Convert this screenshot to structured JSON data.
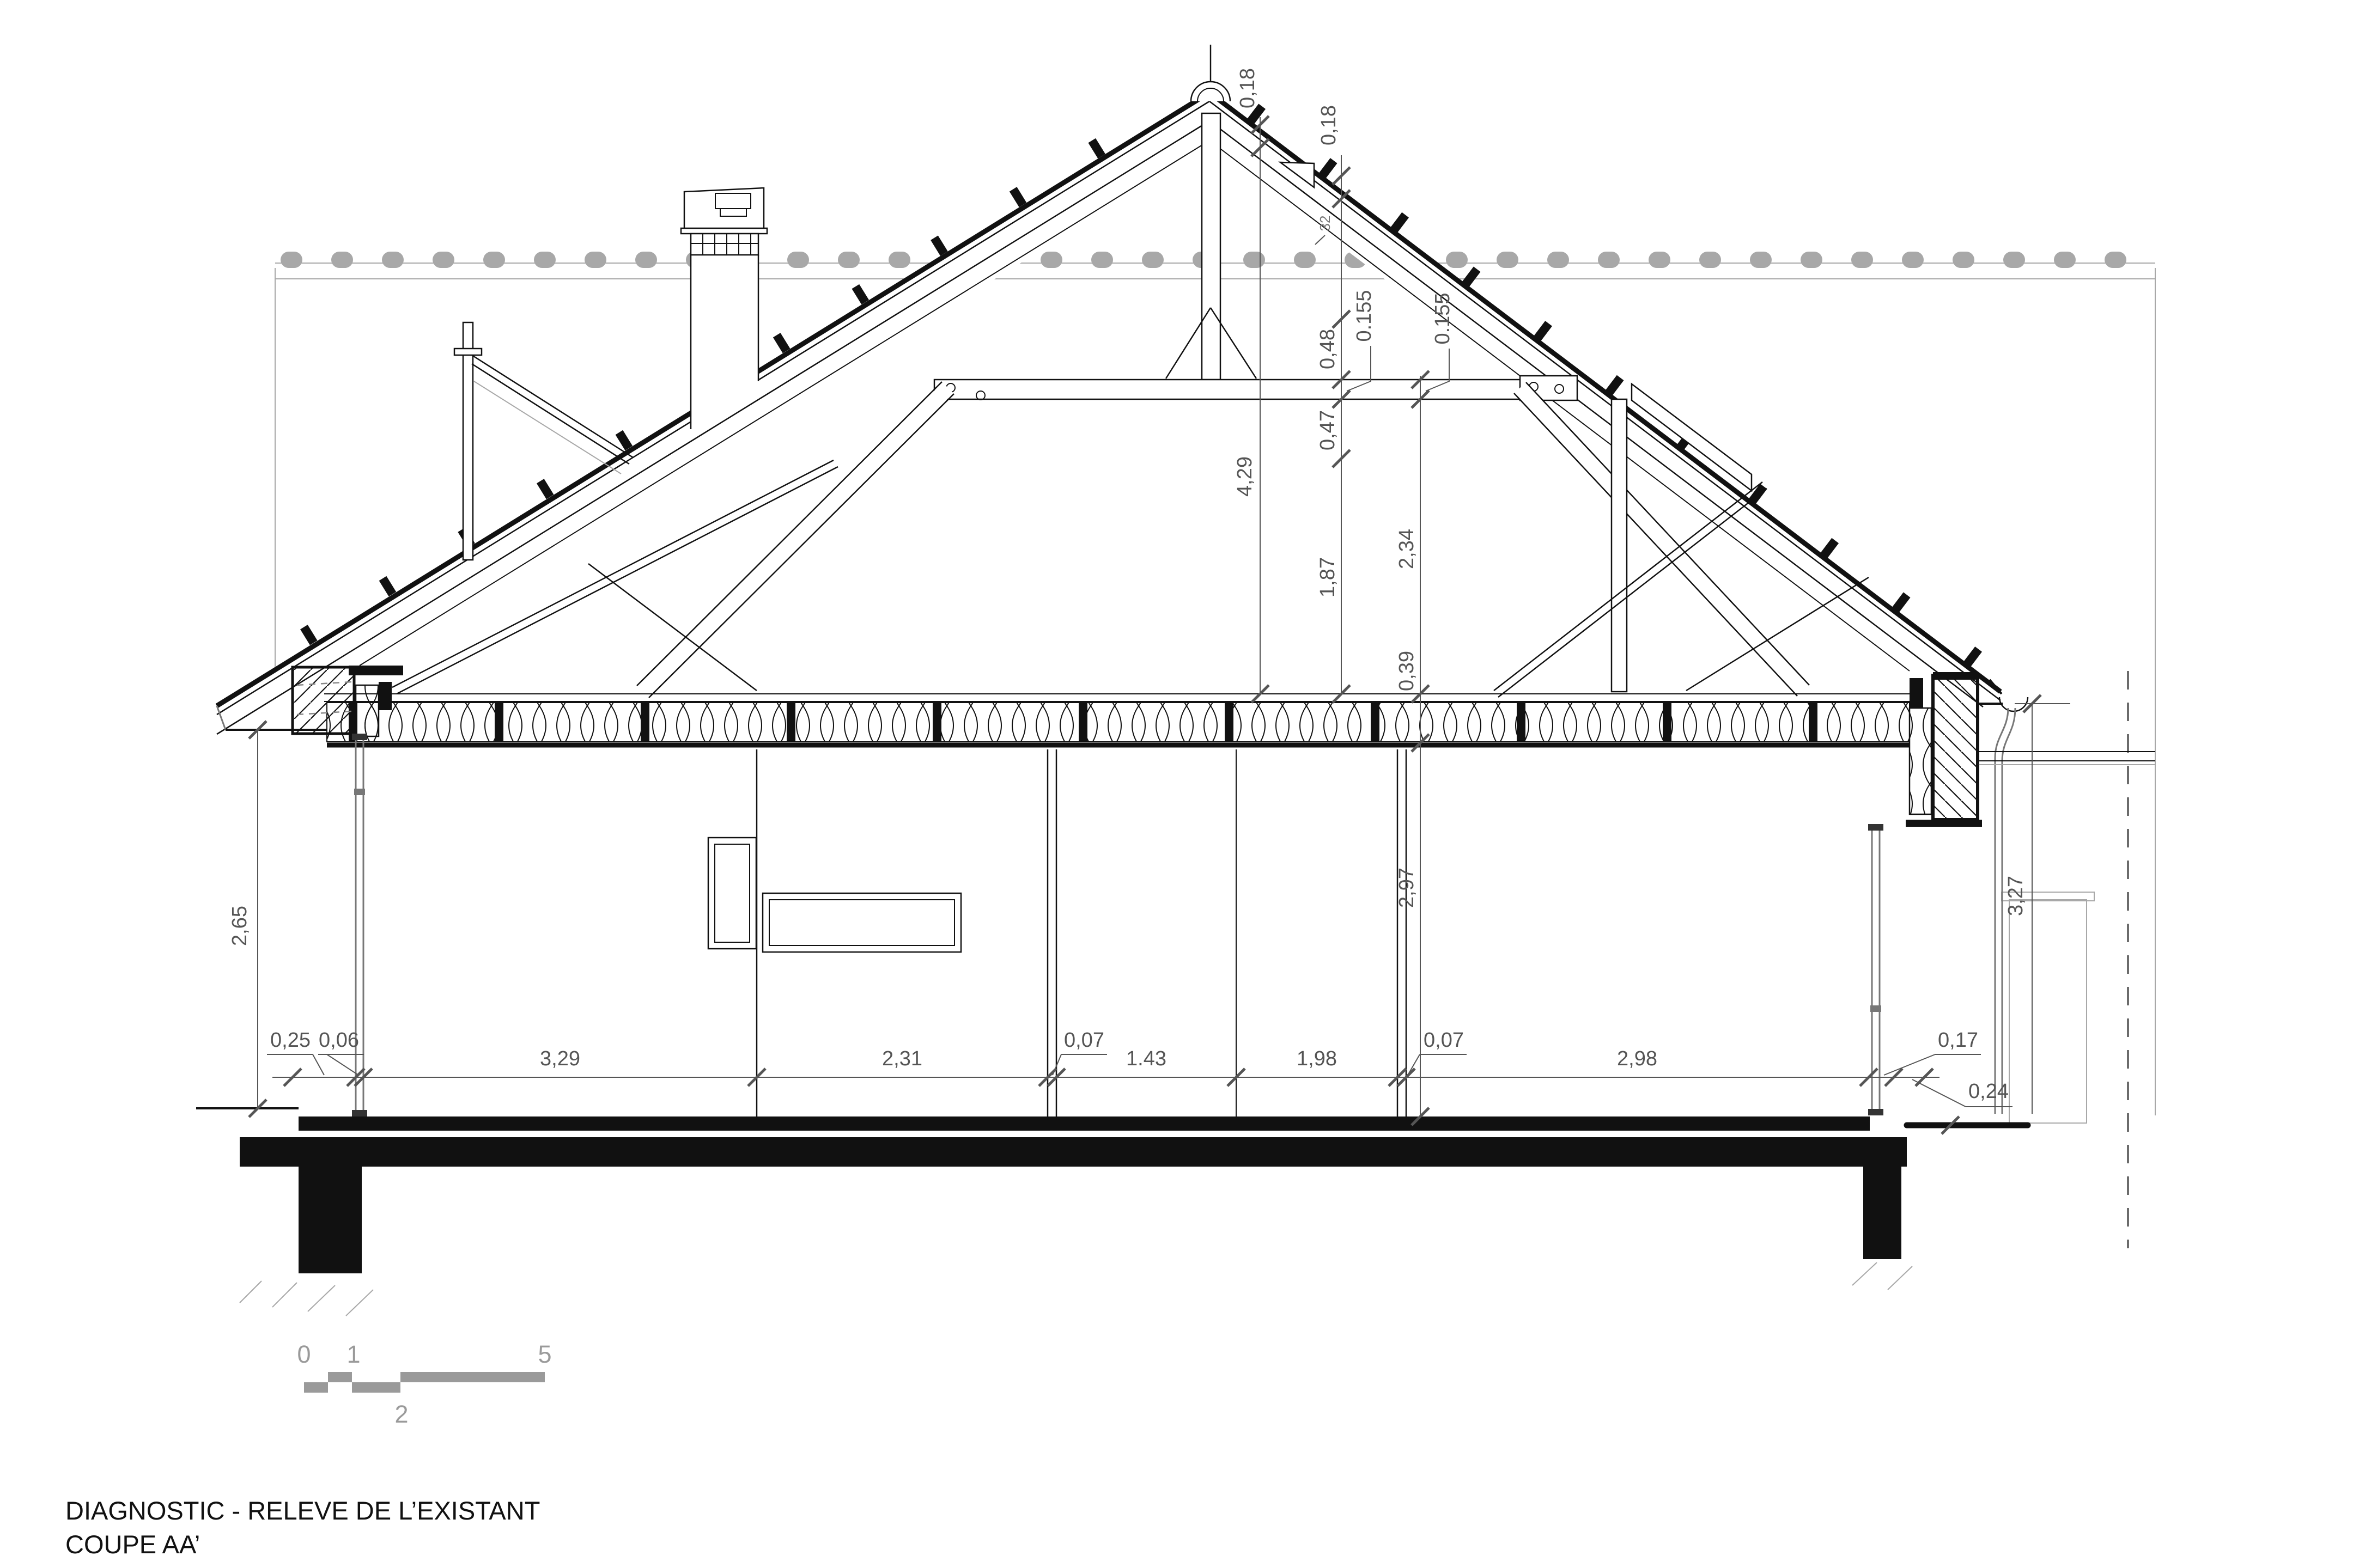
{
  "title": {
    "line1": "DIAGNOSTIC - RELEVE DE L’EXISTANT",
    "line2": "COUPE AA’"
  },
  "scale_bar": {
    "labels": [
      "0",
      "1",
      "2",
      "5"
    ]
  },
  "dimensions": {
    "bottom_chain": [
      "0,25",
      "0,06",
      "3,29",
      "2,31",
      "0,07",
      "1.43",
      "1,98",
      "0,07",
      "2,98",
      "0,17",
      "0,24"
    ],
    "left_height": "2,65",
    "right_height": "3,27",
    "apex_left": {
      "roof_thickness": "0,18",
      "ridge_to_ceiling": "4,29"
    },
    "apex_right": {
      "roof_thickness": "0,18",
      "above_collar": "0,48",
      "collar_thickness": "0.155",
      "below_collar": "0,47",
      "to_ceiling": "1,87"
    },
    "center": {
      "collar_thickness": "0.155",
      "collar_to_ceiling": "2,34",
      "ceiling_thickness": "0,39",
      "room_height": "2,97"
    },
    "roof_note": "32"
  },
  "colors": {
    "line": "#111111",
    "dimension": "#555555",
    "background_gray": "#a8a8a8",
    "scale_gray": "#9a9a9a",
    "paper": "#ffffff"
  }
}
